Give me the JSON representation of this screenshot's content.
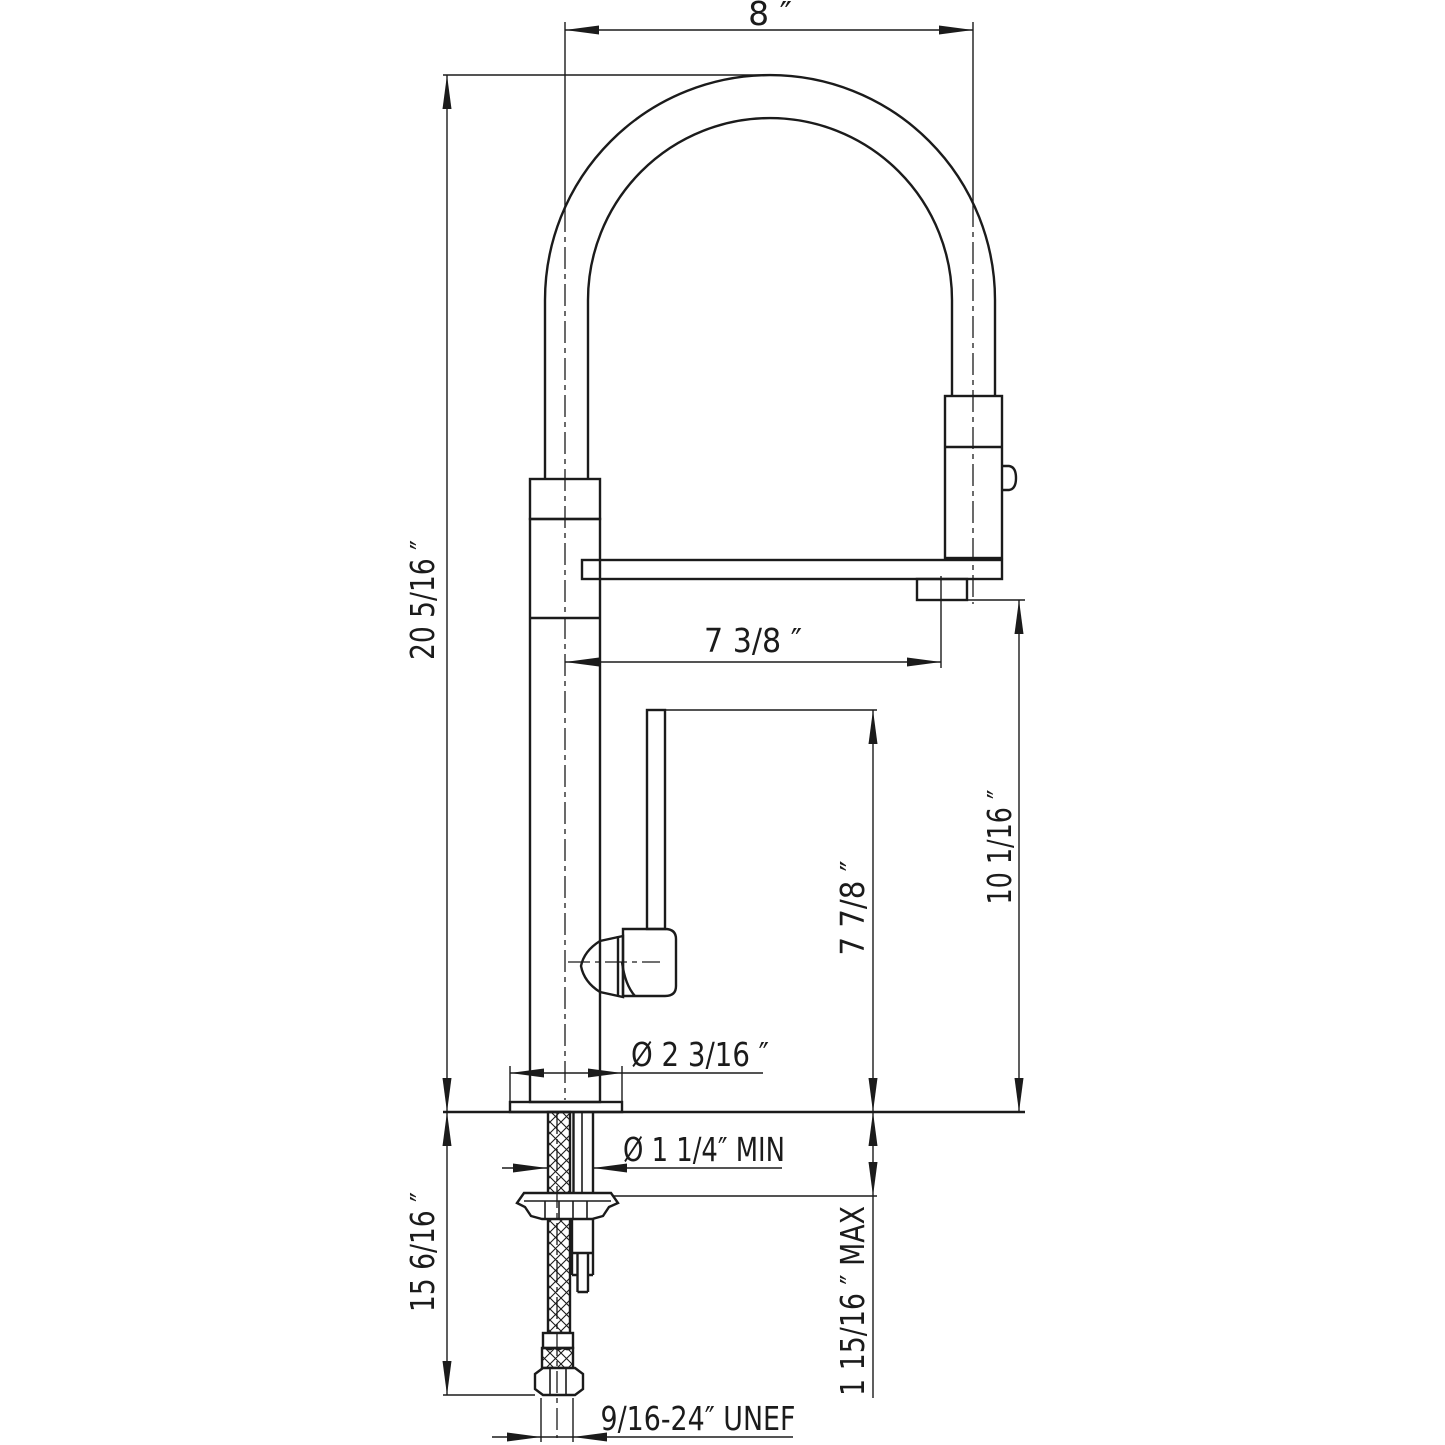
{
  "drawing": {
    "type": "faucet-installation-dimension-drawing",
    "colors": {
      "line": "#1b1b1b",
      "background": "#ffffff"
    },
    "dimensions": {
      "spout_width": "8 ″",
      "overall_height": "20 5/16 ″",
      "spout_reach": "7 3/8 ″",
      "handle_height": "7 7/8 ″",
      "outlet_height": "10 1/16 ″",
      "base_diameter": "Ø 2 3/16 ″",
      "min_hole": "Ø 1 1/4″ MIN",
      "max_counter": "1 15/16 ″ MAX",
      "below_counter": "15 6/16 ″",
      "thread": "9/16-24″ UNEF"
    }
  }
}
